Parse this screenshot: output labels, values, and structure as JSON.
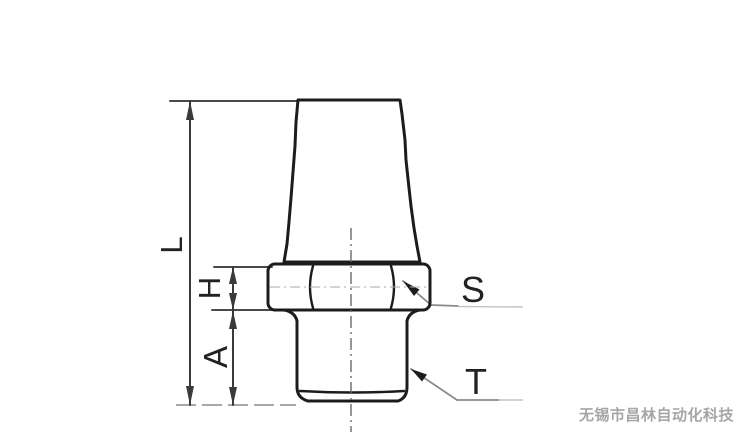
{
  "diagram": {
    "title": "pneumatic-muffler-dimension-drawing",
    "labels": {
      "overall_length": "L",
      "hex_height": "H",
      "thread_engagement": "A",
      "wrench_flats": "S",
      "thread_size": "T"
    },
    "watermark": "无锡市昌林自动化科技",
    "colors": {
      "outline": "#1c1c1c",
      "dimension": "#3a3a3a",
      "extension": "#4a4a4a",
      "baseline": "#8a8a8a",
      "leader": "#8a8a8a",
      "faint": "#c4c4c4",
      "centerline": "#6a6a6a",
      "hex_centerline": "#aaaaaa",
      "label_text": "#222222",
      "watermark_text": "#a6a6a6"
    }
  }
}
